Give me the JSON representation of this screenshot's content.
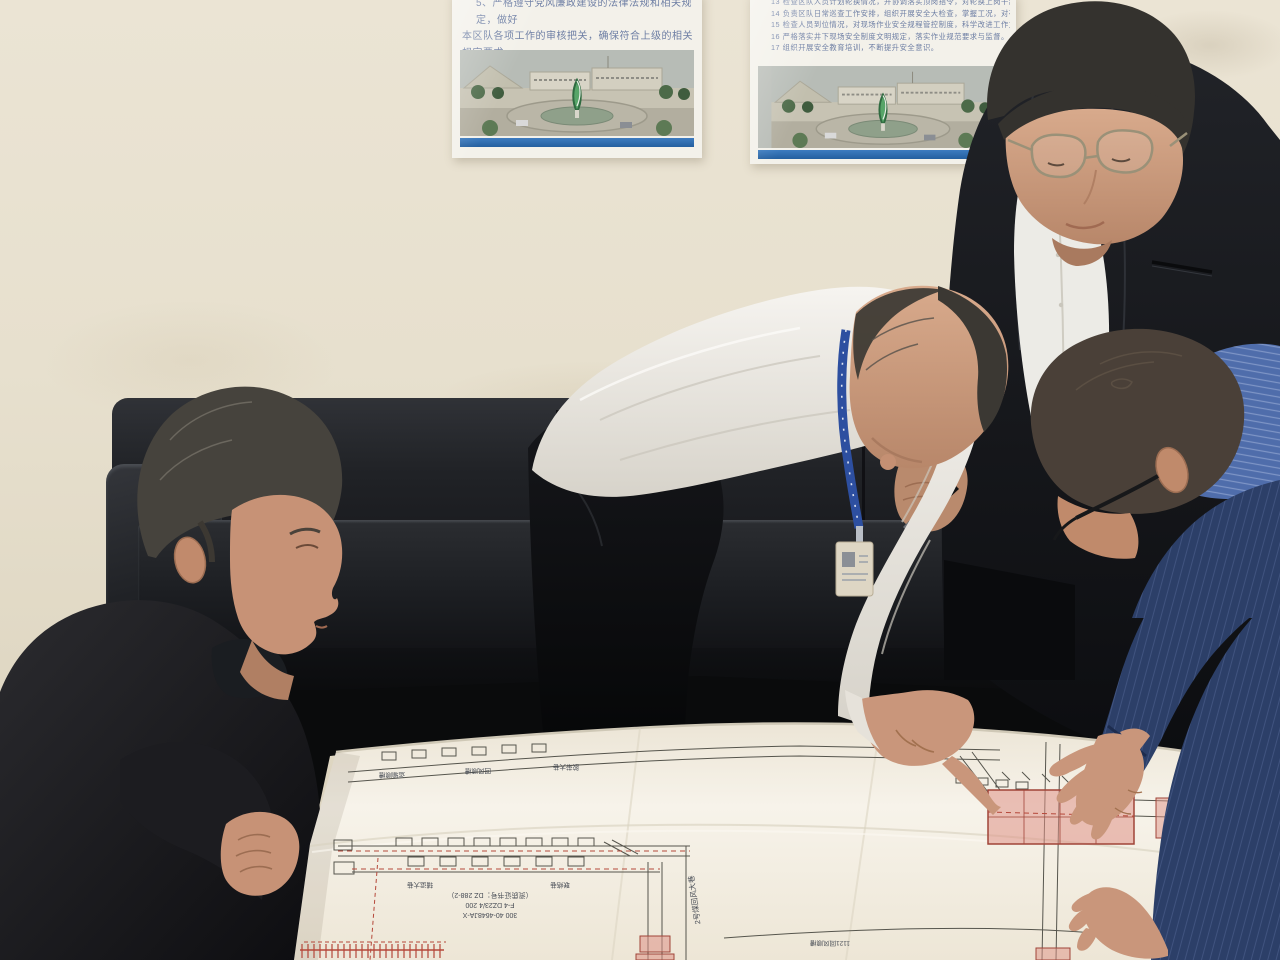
{
  "scene": {
    "description": "Four men in an office lean over a large mine engineering drawing spread on a table; two safety-duty posters hang on the wall above a black leather sofa",
    "people": [
      {
        "id": "man-left",
        "appearance": "crouching man in dark blazer holding the drawing edge"
      },
      {
        "id": "man-center",
        "appearance": "man in white shirt with blue lanyard badge pointing at the drawing"
      },
      {
        "id": "man-tall",
        "appearance": "standing man in black suit, thin glasses, holding a pen"
      },
      {
        "id": "man-right",
        "appearance": "man in blue pinstriped shirt and navy jacket, glasses, both hands on the drawing"
      }
    ],
    "furniture": [
      "black leather sofa",
      "radiator",
      "table with engineering drawing"
    ]
  },
  "posters": {
    "left": {
      "lines": [
        "5、严格遵守党风廉政建设的法律法规和相关规定，做好",
        "本区队各项工作的审核把关，确保符合上级的相关规定要求。",
        "6、配合并支持相关部门和人员开展监督执纪工作。"
      ]
    },
    "right": {
      "lines": [
        "13 检查区队人员计划轮换情况，并协调落实顶岗指令，对轮换上岗干部进行谈话，并做好相关记录备案。",
        "14 负责区队日常巡查工作安排，组织开展安全大检查，掌握工况，对存在问题隐患限期整改落实。",
        "15 检查人员到位情况，对现场作业安全规程管控制度，科学改进工作方式，保障职工生命安全。",
        "16 严格落实井下现场安全制度文明规定，落实作业规范要求与监督。",
        "17 组织开展安全教育培训，不断提升安全意识。"
      ]
    }
  },
  "drawing": {
    "cert_lines": [
      "（资质证书号：DZ 288-2）",
      "F-4 DZ23/4 200",
      "300 40-4648JA-X"
    ],
    "vertical_label": "2号煤回风大巷",
    "diagonal_label": "1121回风顺槽",
    "tunnel_labels": [
      "运输顺槽",
      "回风顺槽",
      "胶带大巷",
      "辅运大巷",
      "联络巷"
    ]
  },
  "palette": {
    "wall": "#e7e0cf",
    "poster_text": "#6d7ea4",
    "poster_strip": "#2e6db4",
    "sofa": "#1d1f22",
    "paper": "#f4f0e7",
    "drawing_line": "#55544e",
    "drawing_red": "#b5483a",
    "drawing_pink": "#e0a49a",
    "skin": "#c99579",
    "shirt_white": "#efede9",
    "suit_black": "#17181c",
    "jacket_navy": "#2c3f68",
    "shirt_blue": "#4f6dab",
    "lanyard": "#2b4d9e"
  }
}
